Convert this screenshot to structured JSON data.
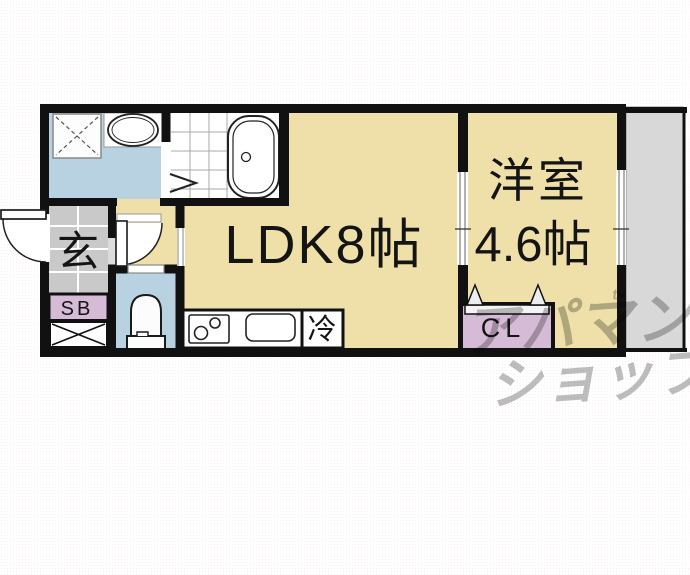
{
  "floorplan": {
    "rooms": {
      "ldk": {
        "label": "LDK8帖"
      },
      "western": {
        "name": "洋室",
        "size": "4.6帖"
      },
      "entrance": {
        "label": "玄"
      },
      "shoe_box": {
        "label": "SB"
      },
      "closet": {
        "label": "CL"
      },
      "refrigerator": {
        "label": "冷"
      }
    },
    "watermark": {
      "line1": "アパマン",
      "line2": "ショップ",
      "tag": "tv"
    },
    "colors": {
      "wall": "#111111",
      "room_beige": "#eee0a8",
      "wet_area_blue": "#b9d2e2",
      "storage_pink": "#d6bbd6",
      "entrance_tile_gray": "#c9c9c9",
      "balcony_gray": "#d8d8d8",
      "watermark_gray": "#bdbdbd"
    }
  }
}
